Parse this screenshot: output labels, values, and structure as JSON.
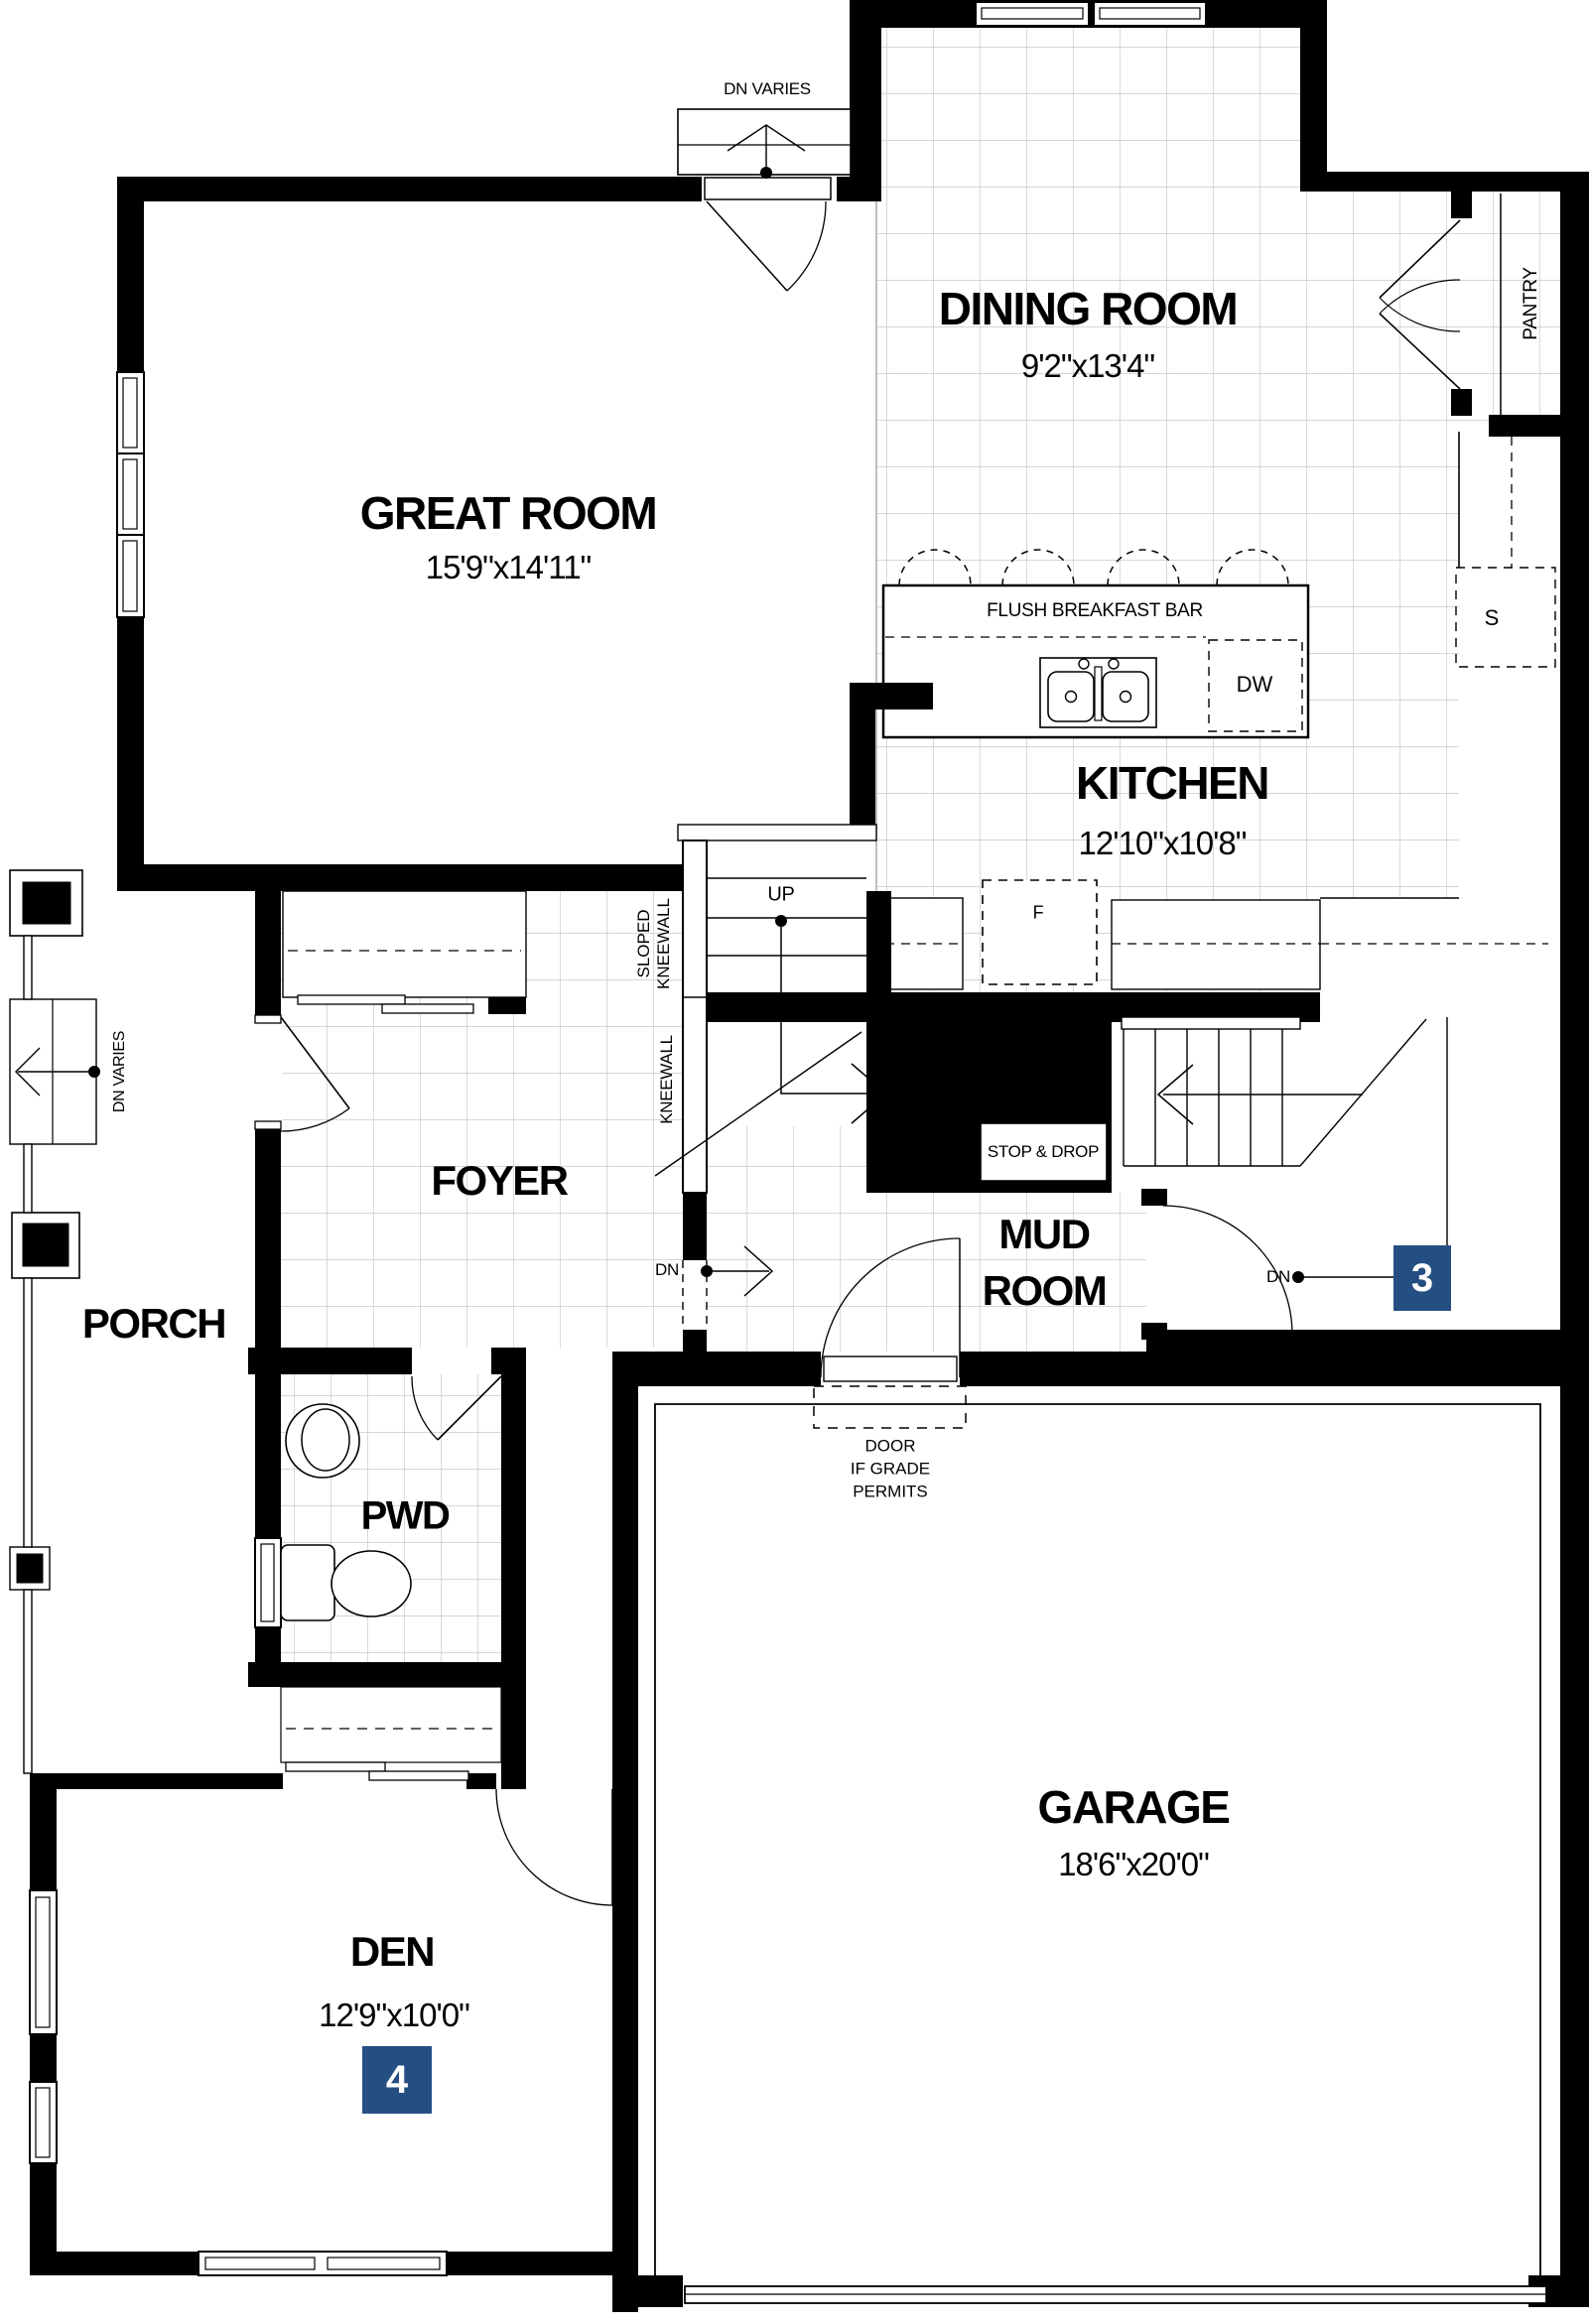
{
  "colors": {
    "wall": "#000000",
    "grid": "#c9c9c9",
    "badge_blue": "#254e82",
    "text": "#000000"
  },
  "rooms": {
    "great_room": {
      "name": "GREAT ROOM",
      "dims": "15'9\"x14'11\""
    },
    "dining_room": {
      "name": "DINING ROOM",
      "dims": "9'2\"x13'4\""
    },
    "kitchen": {
      "name": "KITCHEN",
      "dims": "12'10\"x10'8\""
    },
    "foyer": {
      "name": "FOYER"
    },
    "mud_room": {
      "line1": "MUD",
      "line2": "ROOM"
    },
    "porch": {
      "name": "PORCH"
    },
    "pwd": {
      "name": "PWD"
    },
    "den": {
      "name": "DEN",
      "dims": "12'9\"x10'0\""
    },
    "garage": {
      "name": "GARAGE",
      "dims": "18'6\"x20'0\""
    },
    "pantry": {
      "name": "PANTRY"
    }
  },
  "annotations": {
    "dn_varies_top": "DN VARIES",
    "dn_varies_porch": "DN VARIES",
    "up": "UP",
    "dn_foyer": "DN",
    "dn_basement": "DN",
    "sloped_kneewall_line1": "SLOPED",
    "sloped_kneewall_line2": "KNEEWALL",
    "kneewall": "KNEEWALL",
    "flush_breakfast_bar": "FLUSH BREAKFAST BAR",
    "stop_and_drop": "STOP & DROP",
    "door_grade_line1": "DOOR",
    "door_grade_line2": "IF GRADE",
    "door_grade_line3": "PERMITS",
    "dishwasher": "DW",
    "stove": "S",
    "fridge": "F"
  },
  "badges": {
    "stairs_marker": "3",
    "den_marker": "4"
  }
}
